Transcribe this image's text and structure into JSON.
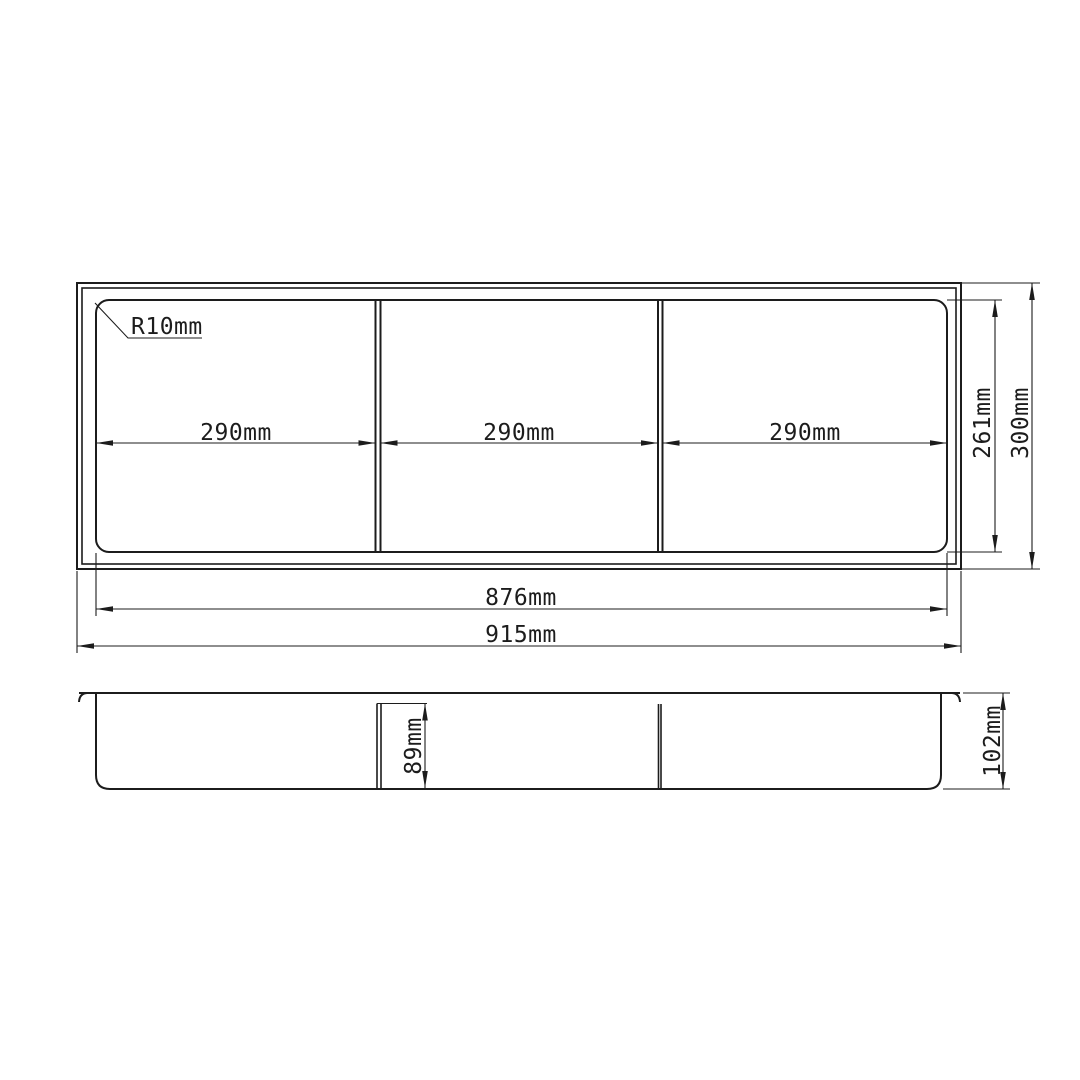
{
  "drawing": {
    "background_color": "#ffffff",
    "line_color": "#1c1c1c",
    "plan_view": {
      "corner_radius_label": "R10mm",
      "section_width_1": "290mm",
      "section_width_2": "290mm",
      "section_width_3": "290mm",
      "inner_width": "876mm",
      "overall_width": "915mm",
      "inner_height": "261mm",
      "overall_height": "300mm"
    },
    "section_view": {
      "divider_height": "89mm",
      "overall_depth": "102mm"
    }
  }
}
